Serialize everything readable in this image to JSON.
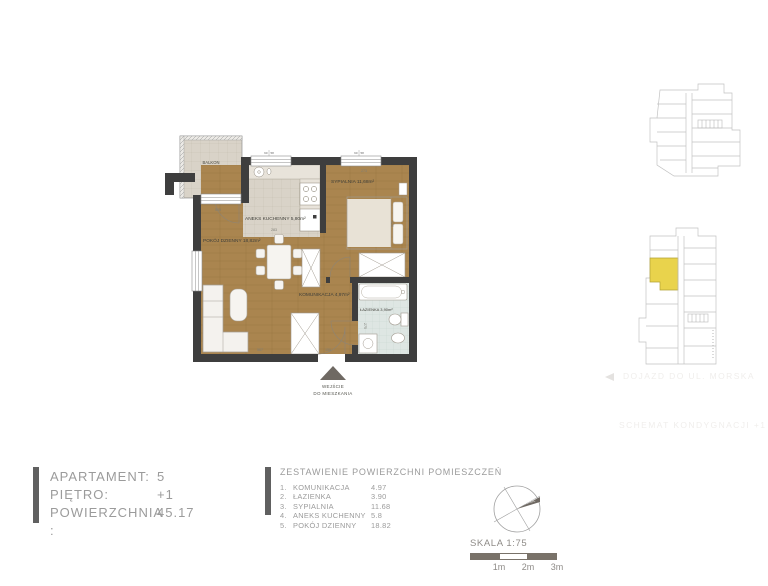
{
  "apartment_info": {
    "rows": [
      {
        "label": "APARTAMENT:",
        "value": "5"
      },
      {
        "label": "PIĘTRO:",
        "value": "+1"
      },
      {
        "label": "POWIERZCHNIA :",
        "value": "45.17"
      }
    ]
  },
  "area_table": {
    "title": "ZESTAWIENIE POWIERZCHNI  POMIESZCZEŃ",
    "rows": [
      {
        "no": "1.",
        "name": "KOMUNIKACJA",
        "value": "4.97"
      },
      {
        "no": "2.",
        "name": "ŁAZIENKA",
        "value": "3.90"
      },
      {
        "no": "3.",
        "name": "SYPIALNIA",
        "value": "11.68"
      },
      {
        "no": "4.",
        "name": "ANEKS KUCHENNY",
        "value": "5.8"
      },
      {
        "no": "5.",
        "name": "POKÓJ DZIENNY",
        "value": "18.82"
      }
    ]
  },
  "floor_plan": {
    "rooms": {
      "balkon_name": "BALKON",
      "balkon_area": "3,71 m²",
      "pokoj_dzienny": "POKÓJ DZIENNY  18,82m²",
      "aneks_kuchenny": "ANEKS KUCHENNY  5,80m²",
      "sypialnia": "SYPIALNIA  11,68m²",
      "komunikacja": "KOMUNIKACJA  4,97m²",
      "lazienka": "ŁAZIENKA  3,90m²"
    },
    "entrance": {
      "line1": "WEJŚCIE",
      "line2": "DO MIESZKANIA"
    },
    "dimensions": {
      "living_top": "505",
      "kitchen": "283",
      "bedroom_top": "273",
      "bedroom_side": "420",
      "bathroom_side": "275",
      "living_bottom": "567",
      "hall_bottom": "150",
      "window_mark_left": "90",
      "window_mark_right": "58"
    }
  },
  "scale": {
    "label": "SKALA 1:75",
    "ticks": [
      "1m",
      "2m",
      "3m"
    ]
  },
  "compass": {
    "north_label": "PÓŁNOC"
  },
  "side_notes": {
    "access_note": "DOJAZD DO UL. MORSKA",
    "floor_schematic_note": "SCHEMAT KONDYGNACJI +1"
  },
  "colors": {
    "wall": "#3e3e3e",
    "wood_floor": "#aa854f",
    "tile_floor": "#d9d3c8",
    "bath_floor": "#dee6e3",
    "highlight_unit": "#e9d34c",
    "text_gray": "#9b9b9b",
    "scale_bar_dark": "#797269"
  }
}
